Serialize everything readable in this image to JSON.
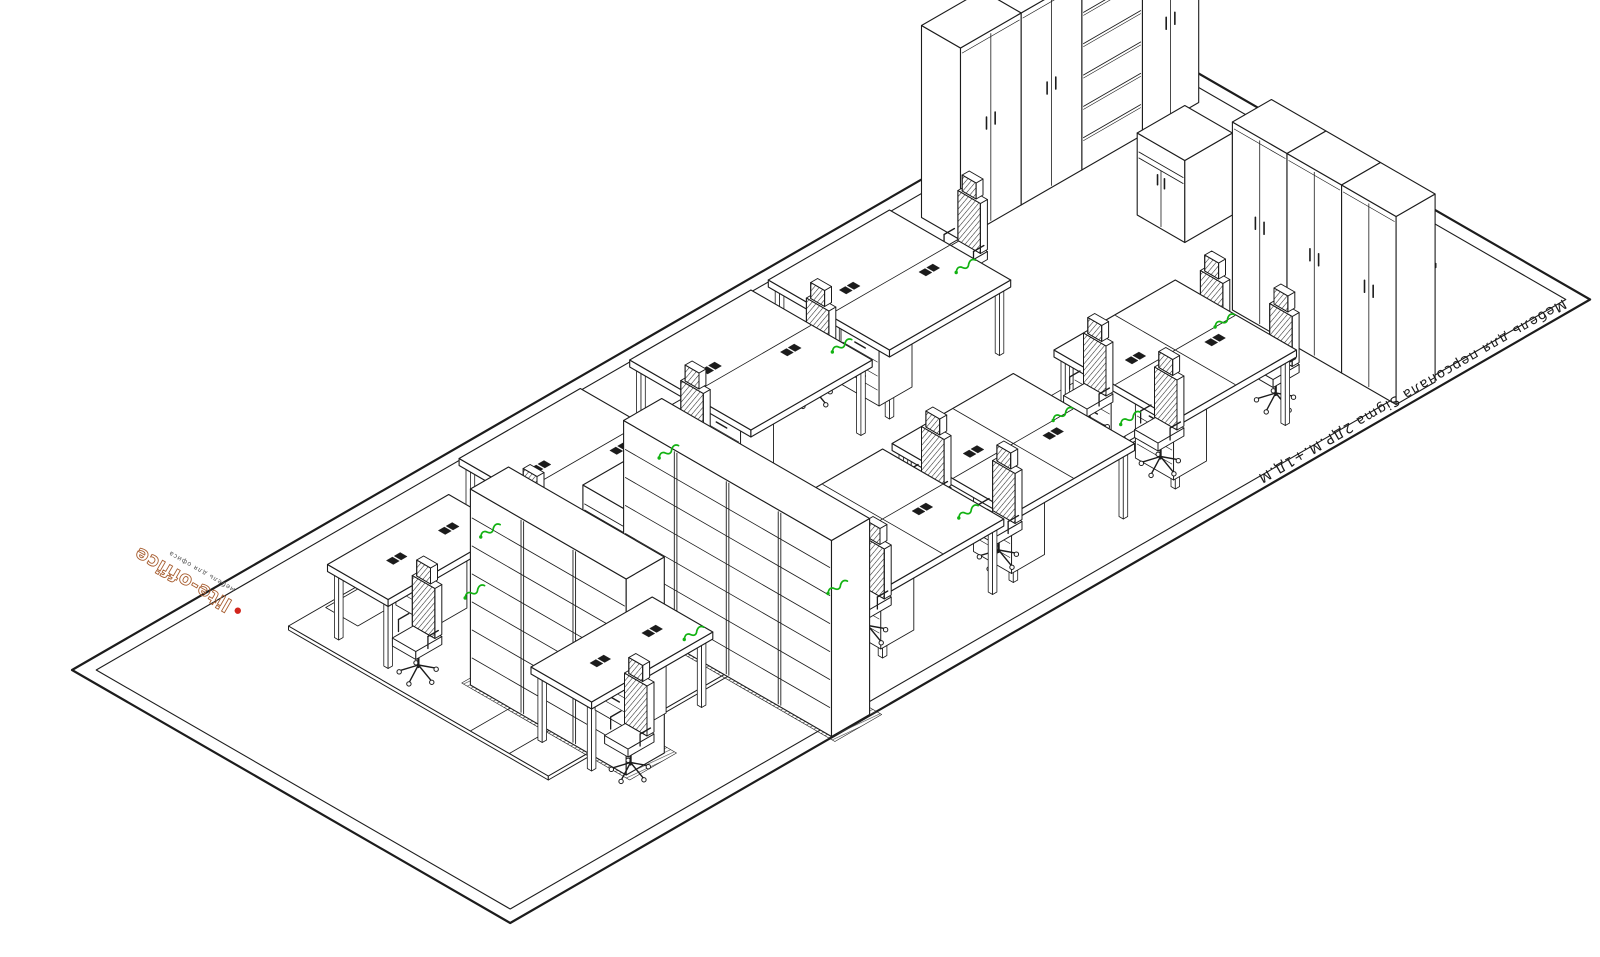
{
  "annotations": {
    "product_label": {
      "text": "Мебель для персонала Sigma 2ДР.М.+1Д.М",
      "color": "#1a1a1a"
    },
    "logo": {
      "text": "lite-office",
      "tagline": "мебель для офиса",
      "color": "#a85f32",
      "accent": "#d2251c"
    }
  },
  "colors": {
    "line": "#1c1c1c",
    "green": "#12b212",
    "paper": "#ffffff"
  },
  "scene": {
    "projection": {
      "ox": 72,
      "oy": 670,
      "k": 0.866
    },
    "border": {
      "outer": [
        [
          0,
          0
        ],
        [
          1247,
          0
        ],
        [
          1247,
          506
        ],
        [
          0,
          506
        ]
      ],
      "inner": [
        [
          14,
          14
        ],
        [
          1233,
          14
        ],
        [
          1233,
          492
        ],
        [
          14,
          492
        ]
      ]
    },
    "slab": {
      "x": 165,
      "y": 85,
      "w": 1025,
      "d": 300,
      "t": 4
    },
    "floor_lines": [
      {
        "a": [
          165,
          295
        ],
        "b": [
          900,
          295
        ]
      },
      {
        "a": [
          165,
          340
        ],
        "b": [
          900,
          340
        ]
      },
      {
        "a": [
          240,
          295
        ],
        "b": [
          240,
          340
        ]
      },
      {
        "a": [
          420,
          340
        ],
        "b": [
          420,
          385
        ]
      },
      {
        "a": [
          560,
          295
        ],
        "b": [
          560,
          340
        ]
      }
    ],
    "floor_rect": {
      "x": 205,
      "y": 88,
      "w": 40,
      "d": 37
    },
    "cabinets": [
      {
        "name": "wardrobe-tall",
        "type": "wardrobe",
        "x": 943,
        "y": 38,
        "w": 70,
        "d": 45,
        "h": 192,
        "face": "y"
      },
      {
        "name": "wardrobe-tall",
        "type": "wardrobe",
        "x": 1013,
        "y": 38,
        "w": 70,
        "d": 45,
        "h": 192,
        "face": "y"
      },
      {
        "name": "bookcase-open",
        "type": "bookcase",
        "x": 1083,
        "y": 38,
        "w": 70,
        "d": 45,
        "h": 188,
        "shelves": 5,
        "face": "y"
      },
      {
        "name": "wardrobe-tall",
        "type": "wardrobe",
        "x": 1153,
        "y": 38,
        "w": 65,
        "d": 45,
        "h": 184,
        "face": "y"
      },
      {
        "name": "low-cabinet",
        "type": "lowcab",
        "x": 1070,
        "y": 160,
        "w": 55,
        "d": 55,
        "h": 82,
        "face": "x"
      },
      {
        "name": "wardrobe-tall",
        "type": "wardrobe",
        "x": 1030,
        "y": 310,
        "w": 45,
        "d": 63,
        "h": 188,
        "face": "x"
      },
      {
        "name": "wardrobe-tall",
        "type": "wardrobe",
        "x": 1030,
        "y": 373,
        "w": 45,
        "d": 63,
        "h": 188,
        "face": "x"
      },
      {
        "name": "wardrobe-tall",
        "type": "wardrobe",
        "x": 1030,
        "y": 436,
        "w": 45,
        "d": 63,
        "h": 188,
        "face": "x"
      },
      {
        "name": "low-cabinet",
        "type": "lowcab",
        "x": 398,
        "y": 192,
        "w": 52,
        "d": 48,
        "h": 82,
        "face": "x"
      }
    ],
    "racks": [
      {
        "name": "shelving-rack-row",
        "x": 215,
        "y": 245,
        "w": 44,
        "len": 180,
        "units": 3,
        "h": 196
      },
      {
        "name": "shelving-rack-row",
        "x": 372,
        "y": 265,
        "w": 44,
        "len": 240,
        "units": 4,
        "h": 196
      }
    ],
    "desks": [
      {
        "name": "desk-island",
        "x": 719,
        "y": 85,
        "w": 140,
        "d": 140,
        "rows": 2,
        "cols": 1,
        "peds": [
          [
            730,
            158
          ]
        ],
        "grom": [
          [
            757,
            141
          ],
          [
            821,
            169
          ]
        ]
      },
      {
        "name": "desk-island",
        "x": 559,
        "y": 85,
        "w": 140,
        "d": 140,
        "rows": 2,
        "cols": 1,
        "peds": [
          [
            570,
            158
          ]
        ],
        "grom": [
          [
            597,
            141
          ],
          [
            661,
            169
          ]
        ]
      },
      {
        "name": "desk-island",
        "x": 362,
        "y": 85,
        "w": 140,
        "d": 140,
        "rows": 2,
        "cols": 1,
        "peds": [
          [
            373,
            158
          ]
        ],
        "grom": [
          [
            400,
            141
          ],
          [
            464,
            169
          ]
        ]
      },
      {
        "name": "desk-single",
        "x": 180,
        "y": 115,
        "w": 140,
        "d": 70,
        "rows": 1,
        "cols": 1,
        "peds": [
          [
            252,
            122
          ]
        ],
        "grom": [
          [
            225,
            150
          ],
          [
            285,
            150
          ]
        ]
      },
      {
        "name": "desk-single",
        "x": 195,
        "y": 335,
        "w": 140,
        "d": 70,
        "rows": 1,
        "cols": 1,
        "peds": [
          [
            262,
            342
          ]
        ],
        "grom": [
          [
            240,
            370
          ],
          [
            300,
            370
          ]
        ]
      },
      {
        "name": "desk-island",
        "x": 814,
        "y": 320,
        "w": 140,
        "d": 140,
        "rows": 2,
        "cols": 2,
        "peds": [
          [
            826,
            330
          ],
          [
            826,
            402
          ]
        ],
        "grom": [
          [
            852,
            376
          ],
          [
            916,
            404
          ]
        ]
      },
      {
        "name": "desk-island",
        "x": 627,
        "y": 320,
        "w": 140,
        "d": 140,
        "rows": 2,
        "cols": 2,
        "peds": [
          [
            639,
            330
          ],
          [
            639,
            402
          ]
        ],
        "grom": [
          [
            665,
            376
          ],
          [
            729,
            404
          ]
        ]
      },
      {
        "name": "desk-island",
        "x": 476,
        "y": 320,
        "w": 140,
        "d": 140,
        "rows": 2,
        "cols": 2,
        "peds": [
          [
            488,
            330
          ],
          [
            488,
            402
          ]
        ],
        "grom": [
          [
            514,
            376
          ],
          [
            578,
            404
          ]
        ]
      }
    ],
    "chairs": [
      [
        895,
        135
      ],
      [
        700,
        155
      ],
      [
        545,
        165
      ],
      [
        348,
        175
      ],
      [
        195,
        205
      ],
      [
        220,
        425
      ],
      [
        825,
        350
      ],
      [
        832,
        425
      ],
      [
        638,
        350
      ],
      [
        645,
        425
      ],
      [
        487,
        350
      ],
      [
        494,
        425
      ],
      [
        955,
        355
      ],
      [
        962,
        428
      ]
    ],
    "squiggles": [
      [
        863,
        158
      ],
      [
        712,
        166
      ],
      [
        506,
        172
      ],
      [
        324,
        148
      ],
      [
        958,
        362
      ],
      [
        806,
        405
      ],
      [
        771,
        362
      ],
      [
        619,
        405
      ],
      [
        468,
        405
      ],
      [
        339,
        368
      ],
      [
        254,
        200
      ]
    ]
  }
}
